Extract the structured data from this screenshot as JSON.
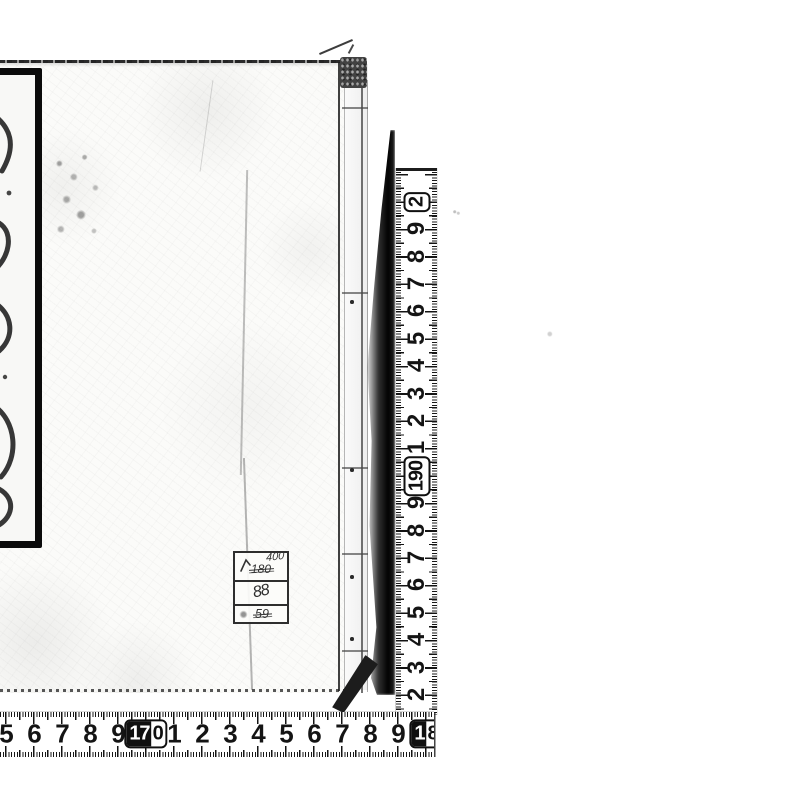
{
  "scan": {
    "background_color": "#ffffff",
    "ink_color": "#141414",
    "subject": "bound-book-cover-scan"
  },
  "price_label": {
    "top_value": "400",
    "crossed_value_1": "180",
    "middle_value": "88",
    "crossed_value_2": "59"
  },
  "horizontal_ruler": {
    "orientation": "bottom-edge",
    "numbers_left_to_right": [
      {
        "label": "5"
      },
      {
        "label": "6"
      },
      {
        "label": "7"
      },
      {
        "label": "8"
      },
      {
        "label": "9"
      },
      {
        "label": "170",
        "box": "split",
        "inverted": "17",
        "plain": "0"
      },
      {
        "label": "1"
      },
      {
        "label": "2"
      },
      {
        "label": "3"
      },
      {
        "label": "4"
      },
      {
        "label": "5"
      },
      {
        "label": "6"
      },
      {
        "label": "7"
      },
      {
        "label": "8"
      },
      {
        "label": "9"
      },
      {
        "label": "18",
        "box": "split",
        "inverted": "1",
        "plain": "8"
      }
    ]
  },
  "vertical_ruler": {
    "orientation": "right-edge",
    "numbers_bottom_to_top": [
      {
        "label": "2"
      },
      {
        "label": "3"
      },
      {
        "label": "4"
      },
      {
        "label": "5"
      },
      {
        "label": "6"
      },
      {
        "label": "7"
      },
      {
        "label": "8"
      },
      {
        "label": "9"
      },
      {
        "label": "190",
        "box": "outline"
      },
      {
        "label": "1"
      },
      {
        "label": "2"
      },
      {
        "label": "3"
      },
      {
        "label": "4"
      },
      {
        "label": "5"
      },
      {
        "label": "6"
      },
      {
        "label": "7"
      },
      {
        "label": "8"
      },
      {
        "label": "9"
      },
      {
        "label": "2",
        "box": "outline"
      }
    ]
  }
}
